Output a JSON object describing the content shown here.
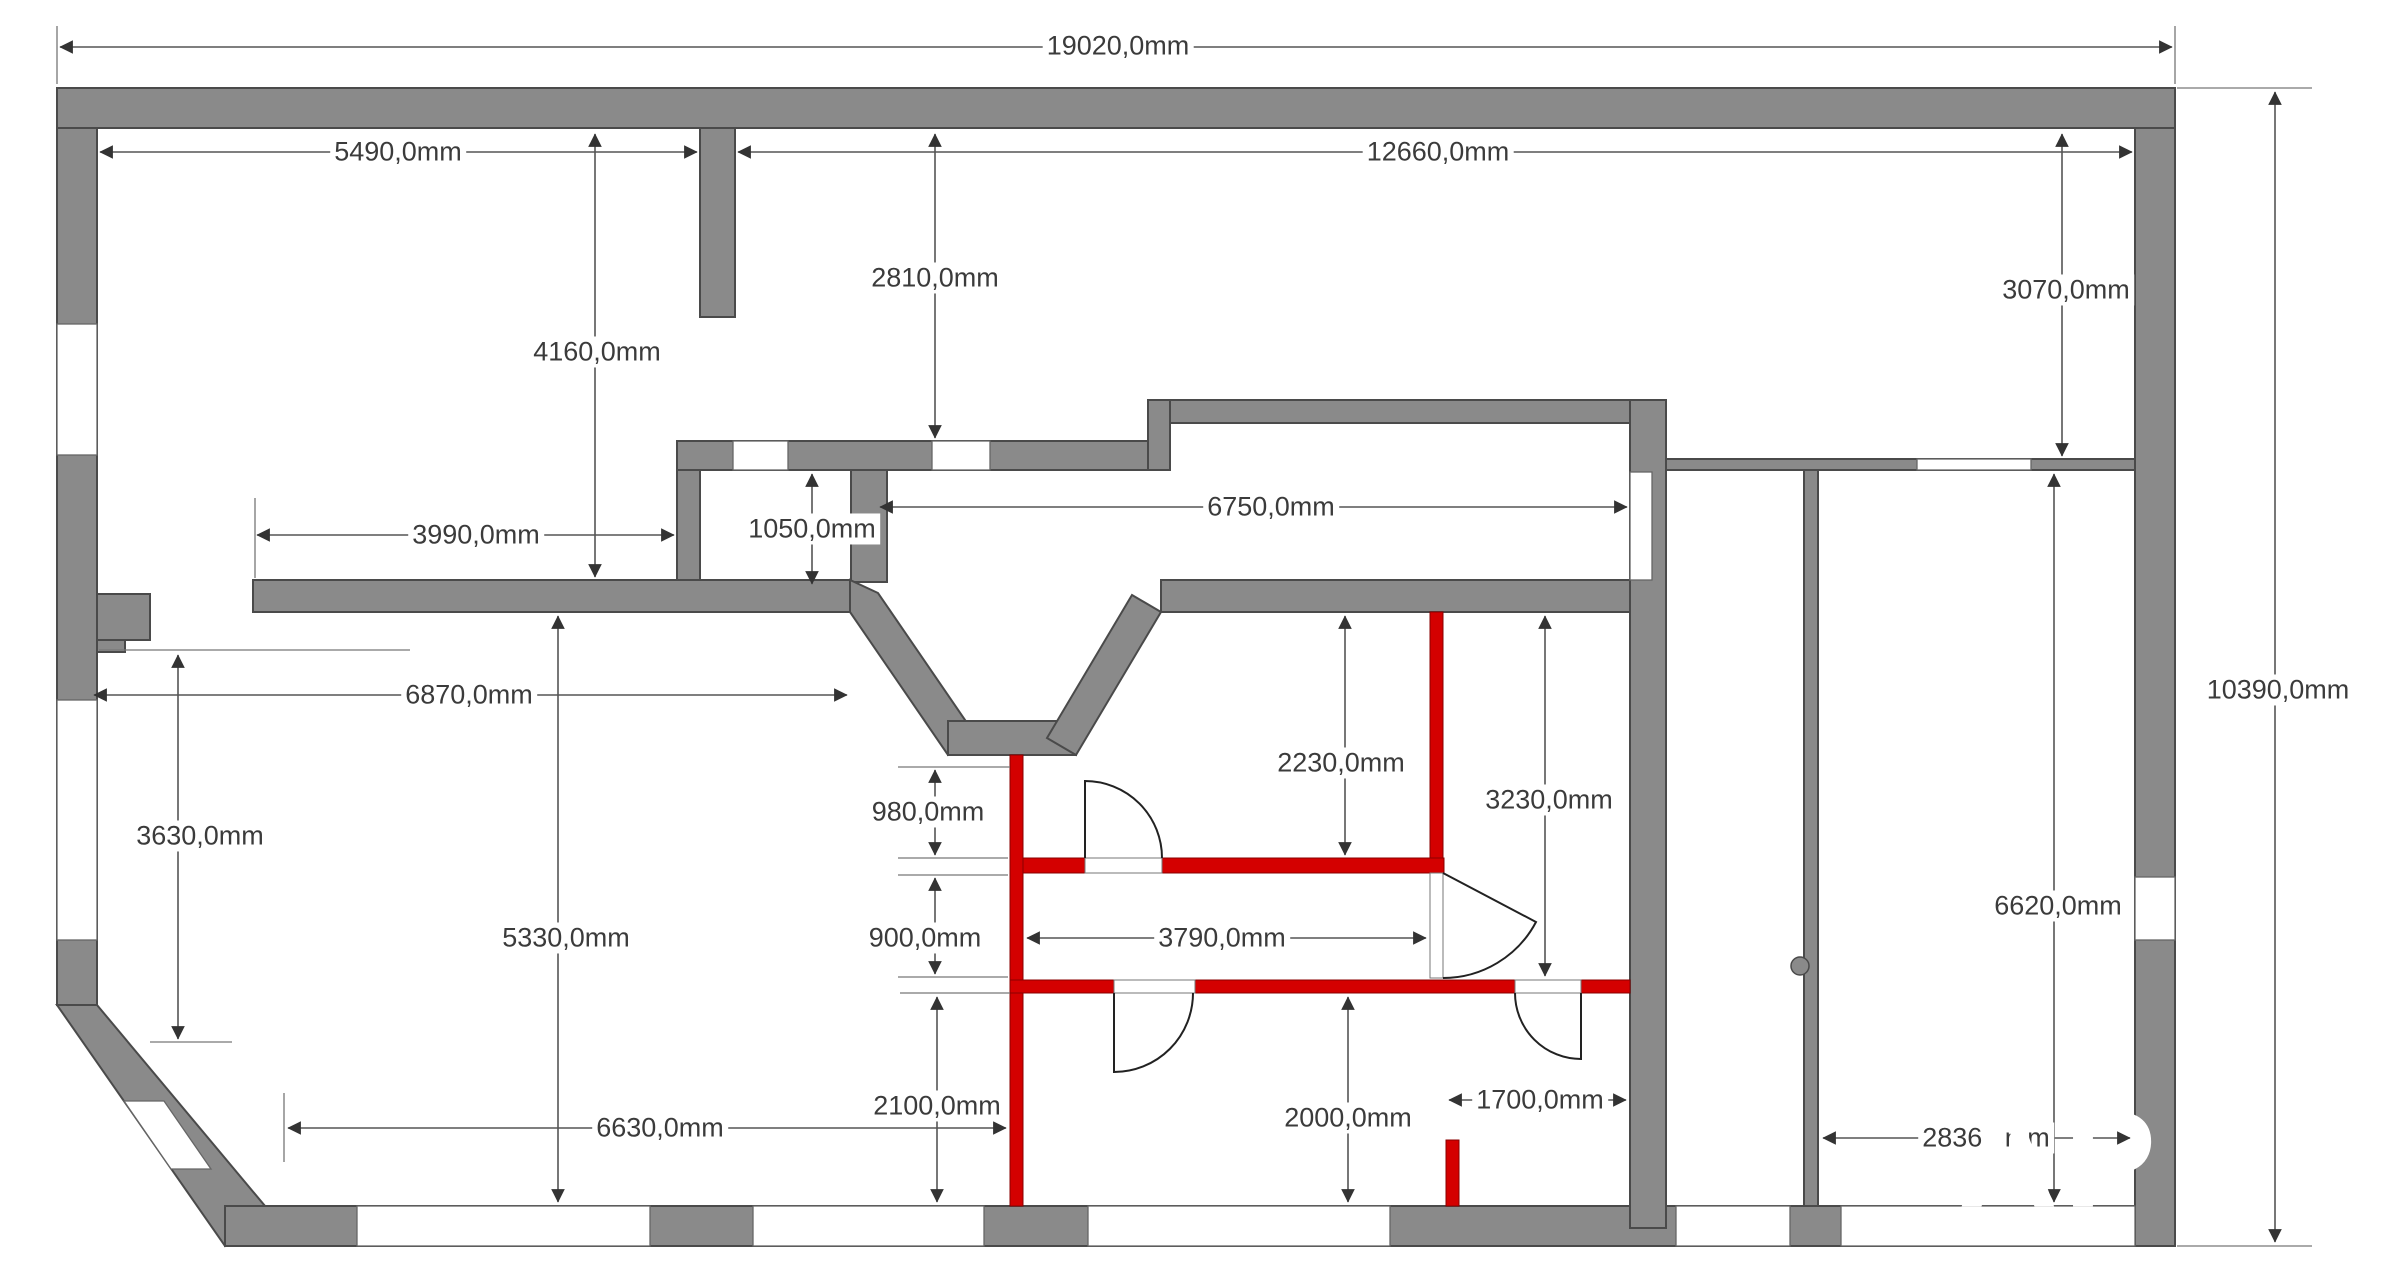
{
  "document": {
    "type": "architectural floor plan with wall dimensions",
    "units": "mm"
  },
  "colors": {
    "wall_gray": "#8a8a8a",
    "wall_outline": "#4a4a4a",
    "wall_red": "#d40000",
    "dimension_text": "#3b3b3b",
    "dimension_line": "#555555",
    "background": "#ffffff",
    "watermark": "#ffffff"
  },
  "dimensions": {
    "overall_width": "19020,0mm",
    "top_left_room_width": "5490,0mm",
    "top_right_span": "12660,0mm",
    "hall_depth": "2810,0mm",
    "left_room_depth": "4160,0mm",
    "right_top_depth": "3070,0mm",
    "mid_left_width": "3990,0mm",
    "closet_height": "1050,0mm",
    "mid_room_width": "6750,0mm",
    "left_room_width": "6870,0mm",
    "left_wall_height": "3630,0mm",
    "living_room_height": "5330,0mm",
    "bay_to_red_wall": "980,0mm",
    "corridor_height": "900,0mm",
    "corridor_width": "3790,0mm",
    "red_room_top_height": "2230,0mm",
    "red_room_right_height": "3230,0mm",
    "bottom_left_width": "6630,0mm",
    "lower_left_room_height": "2100,0mm",
    "lower_right_room_height": "2000,0mm",
    "niche_width": "1700,0mm",
    "right_room_width": "2836,9mm",
    "right_room_height": "6620,0mm",
    "overall_height": "10390,0mm"
  },
  "watermark": {
    "big": "AP",
    "small": "T L"
  }
}
